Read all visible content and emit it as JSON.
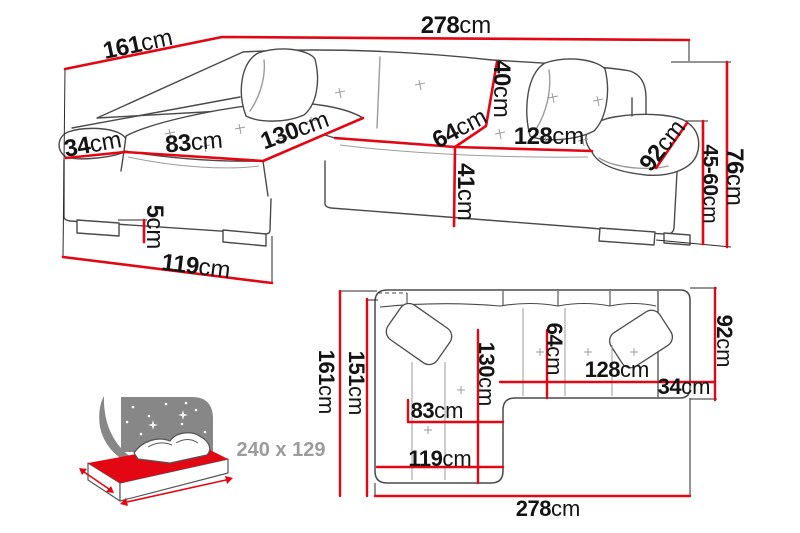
{
  "colors": {
    "dimension_red": "#e30613",
    "outline_gray": "#4a4a4a",
    "seam_gray": "#9b9b9b",
    "text_dark": "#141414",
    "text_gray": "#9c9c9c",
    "background": "#ffffff"
  },
  "perspective_view": {
    "d278": {
      "value": "278",
      "unit": "cm"
    },
    "d161": {
      "value": "161",
      "unit": "cm"
    },
    "d34": {
      "value": "34",
      "unit": "cm"
    },
    "d83": {
      "value": "83",
      "unit": "cm"
    },
    "d130": {
      "value": "130",
      "unit": "cm"
    },
    "d40": {
      "value": "40",
      "unit": "cm"
    },
    "d64": {
      "value": "64",
      "unit": "cm"
    },
    "d128": {
      "value": "128",
      "unit": "cm"
    },
    "d92": {
      "value": "92",
      "unit": "cm"
    },
    "d41": {
      "value": "41",
      "unit": "cm"
    },
    "d76": {
      "value": "76",
      "unit": "cm"
    },
    "d4560": {
      "value": "45-60",
      "unit": "cm"
    },
    "d5": {
      "value": "5",
      "unit": "cm"
    },
    "d119": {
      "value": "119",
      "unit": "cm"
    }
  },
  "plan_view": {
    "p161": {
      "value": "161",
      "unit": "cm"
    },
    "p151": {
      "value": "151",
      "unit": "cm"
    },
    "p130": {
      "value": "130",
      "unit": "cm"
    },
    "p64": {
      "value": "64",
      "unit": "cm"
    },
    "p128": {
      "value": "128",
      "unit": "cm"
    },
    "p34": {
      "value": "34",
      "unit": "cm"
    },
    "p92": {
      "value": "92",
      "unit": "cm"
    },
    "p83": {
      "value": "83",
      "unit": "cm"
    },
    "p119": {
      "value": "119",
      "unit": "cm"
    },
    "p278": {
      "value": "278",
      "unit": "cm"
    }
  },
  "sleeping": {
    "size_label": "240 x 129"
  }
}
